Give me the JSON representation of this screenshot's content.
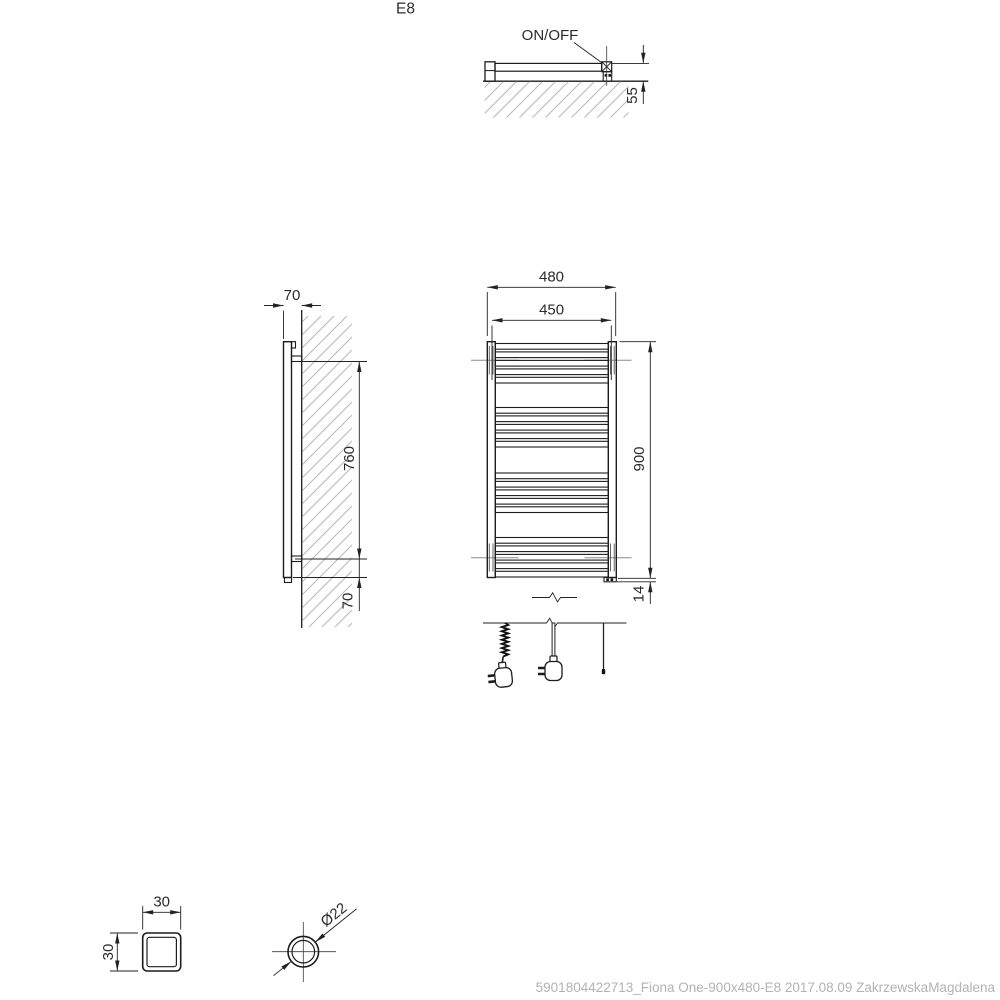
{
  "drawing": {
    "model_label": "E8",
    "footer_note": "5901804422713_Fiona One-900x480-E8 2017.08.09 ZakrzewskaMagdalena"
  },
  "top_view": {
    "switch_label": "ON/OFF",
    "depth_dim": "55"
  },
  "side_view": {
    "depth_dim": "70",
    "bracket_spacing_dim": "760",
    "bottom_offset_dim": "70"
  },
  "front_view": {
    "overall_width_dim": "480",
    "inner_width_dim": "450",
    "height_dim": "900",
    "element_offset_dim": "14"
  },
  "details": {
    "square_profile": {
      "width_dim": "30",
      "height_dim": "30"
    },
    "tube_profile": {
      "diameter_dim": "Ø22"
    }
  },
  "colors": {
    "line": "#1c1c1c",
    "hatch": "#b9b9b9",
    "muted_text": "#b3b3b3"
  }
}
